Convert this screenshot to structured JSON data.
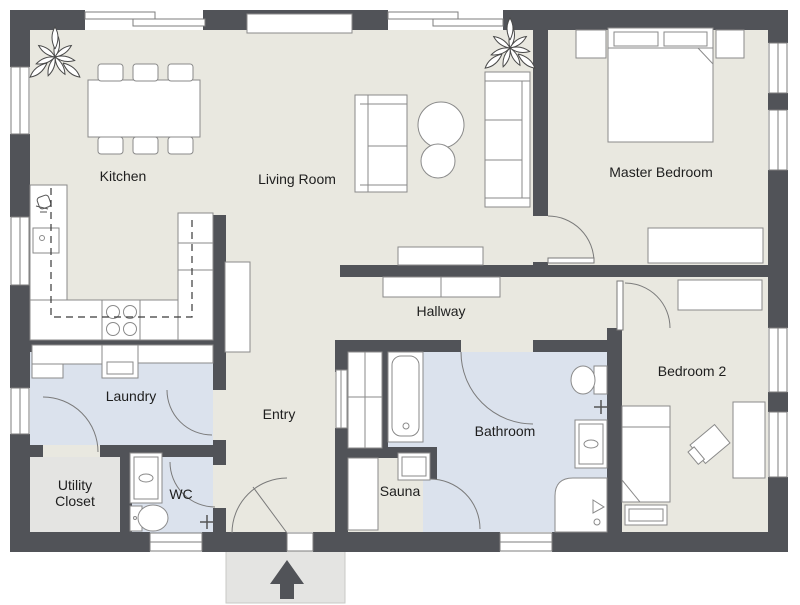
{
  "title": "Floor plan",
  "rooms": {
    "kitchen": {
      "label": "Kitchen"
    },
    "living_room": {
      "label": "Living Room"
    },
    "master_bedroom": {
      "label": "Master Bedroom"
    },
    "hallway": {
      "label": "Hallway"
    },
    "bedroom2": {
      "label": "Bedroom 2"
    },
    "bathroom": {
      "label": "Bathroom"
    },
    "sauna": {
      "label": "Sauna"
    },
    "entry": {
      "label": "Entry"
    },
    "laundry": {
      "label": "Laundry"
    },
    "wc": {
      "label": "WC"
    },
    "utility_closet": {
      "label_line1": "Utility",
      "label_line2": "Closet"
    }
  },
  "icons": {
    "entrance_arrow": "arrow-up",
    "plants": [
      "plant-kitchen-corner",
      "plant-living-corner"
    ]
  },
  "palette": {
    "wall": "#515358",
    "floor_main": "#e9e8e0",
    "floor_wet": "#dbe2ed",
    "floor_utility": "#e4e4e2",
    "porch": "#e4e4e2",
    "furniture_fill": "#ffffff",
    "furniture_stroke": "#8a8a8a",
    "door_arc": "#7a7a7a",
    "text": "#1e1e1e"
  }
}
